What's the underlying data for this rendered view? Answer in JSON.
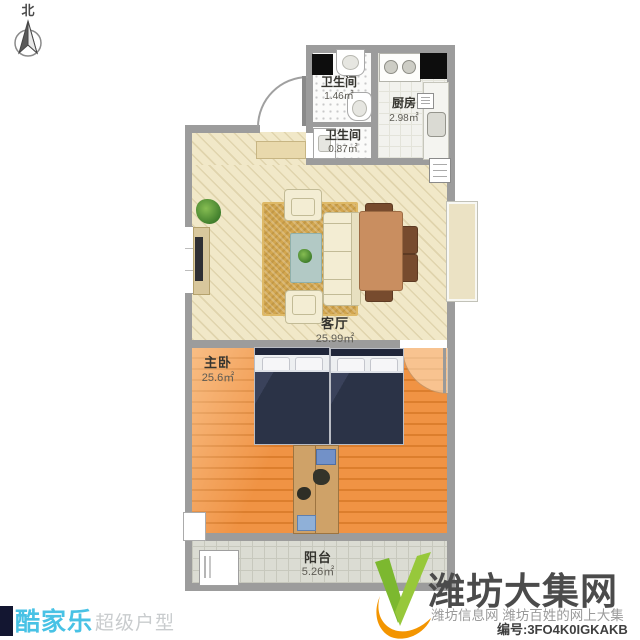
{
  "compass": {
    "north_label": "北"
  },
  "floorplan": {
    "rooms": {
      "bathroom_top": {
        "name": "卫生间",
        "area": "1.46㎡"
      },
      "bathroom_bottom": {
        "name": "卫生间",
        "area": "0.87㎡"
      },
      "kitchen": {
        "name": "厨房",
        "area": "2.98㎡"
      },
      "living_room": {
        "name": "客厅",
        "area": "25.99㎡"
      },
      "master_bedroom": {
        "name": "主卧",
        "area": "25.6㎡"
      },
      "balcony": {
        "name": "阳台",
        "area": "5.26㎡"
      }
    }
  },
  "branding": {
    "kujiale_logo_text": "酷家乐",
    "kujiale_tagline": "超级户型"
  },
  "watermark": {
    "site_name": "潍坊大集网",
    "subtitle": "潍坊信息网 潍坊百姓的网上大集",
    "serial": "编号:3FO4K0IGKAKB"
  },
  "colors": {
    "wall": "#9c9c9c",
    "living_floor": "#f1e8c8",
    "bedroom_floor": "#e8873a",
    "balcony_floor": "#dbdcd3",
    "bed_blanket": "#2b3347",
    "rug": "#d2a64f",
    "brand_cyan": "#48c2e5",
    "logo_green": "#7fbf3f",
    "logo_orange": "#f39500",
    "watermark_gray": "#4b4b4b"
  }
}
